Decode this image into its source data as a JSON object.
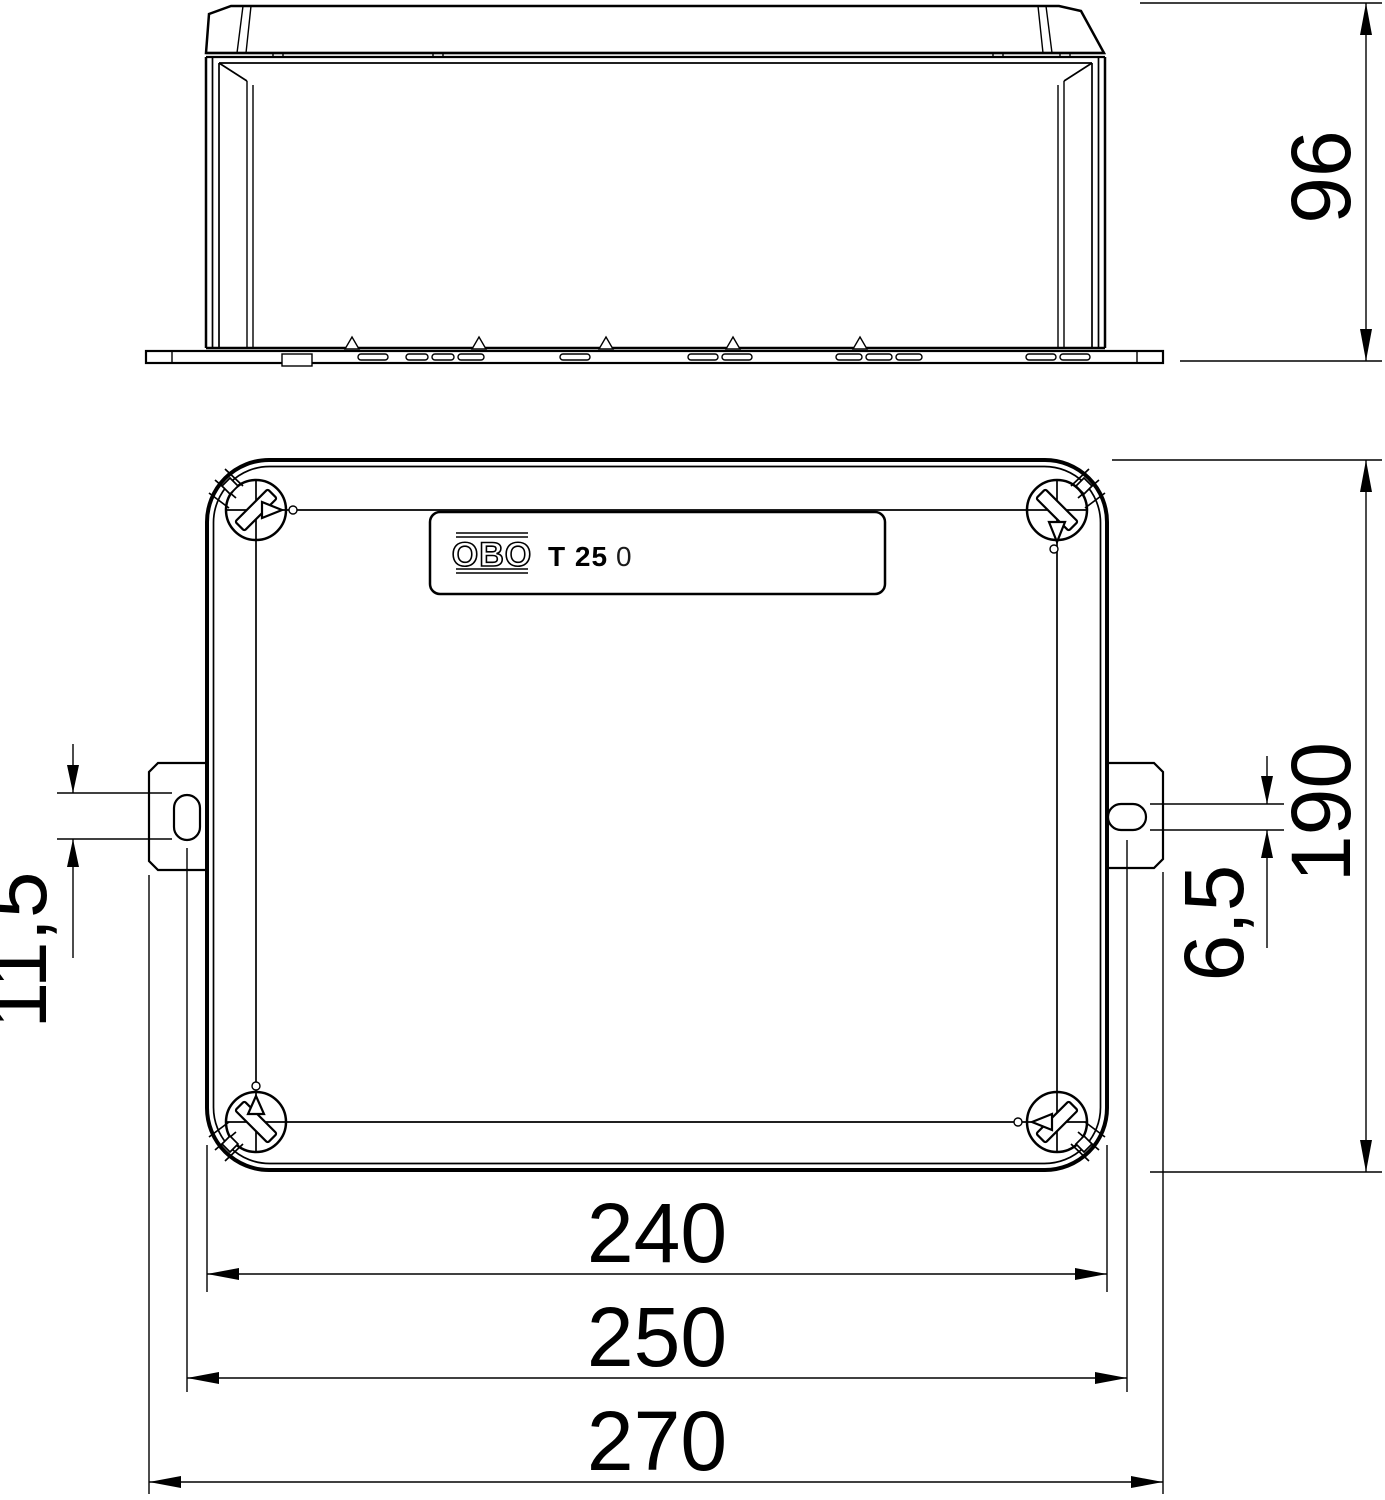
{
  "drawing": {
    "colors": {
      "background": "#ffffff",
      "line": "#000000"
    },
    "label": {
      "brand": "OBO",
      "model": "T 25",
      "model_suffix": "0"
    },
    "dimensions": {
      "height": "96",
      "depth": "190",
      "slot_length": "11,5",
      "slot_width": "6,5",
      "body_width": "240",
      "fixing_centres": "250",
      "overall_width": "270"
    }
  }
}
